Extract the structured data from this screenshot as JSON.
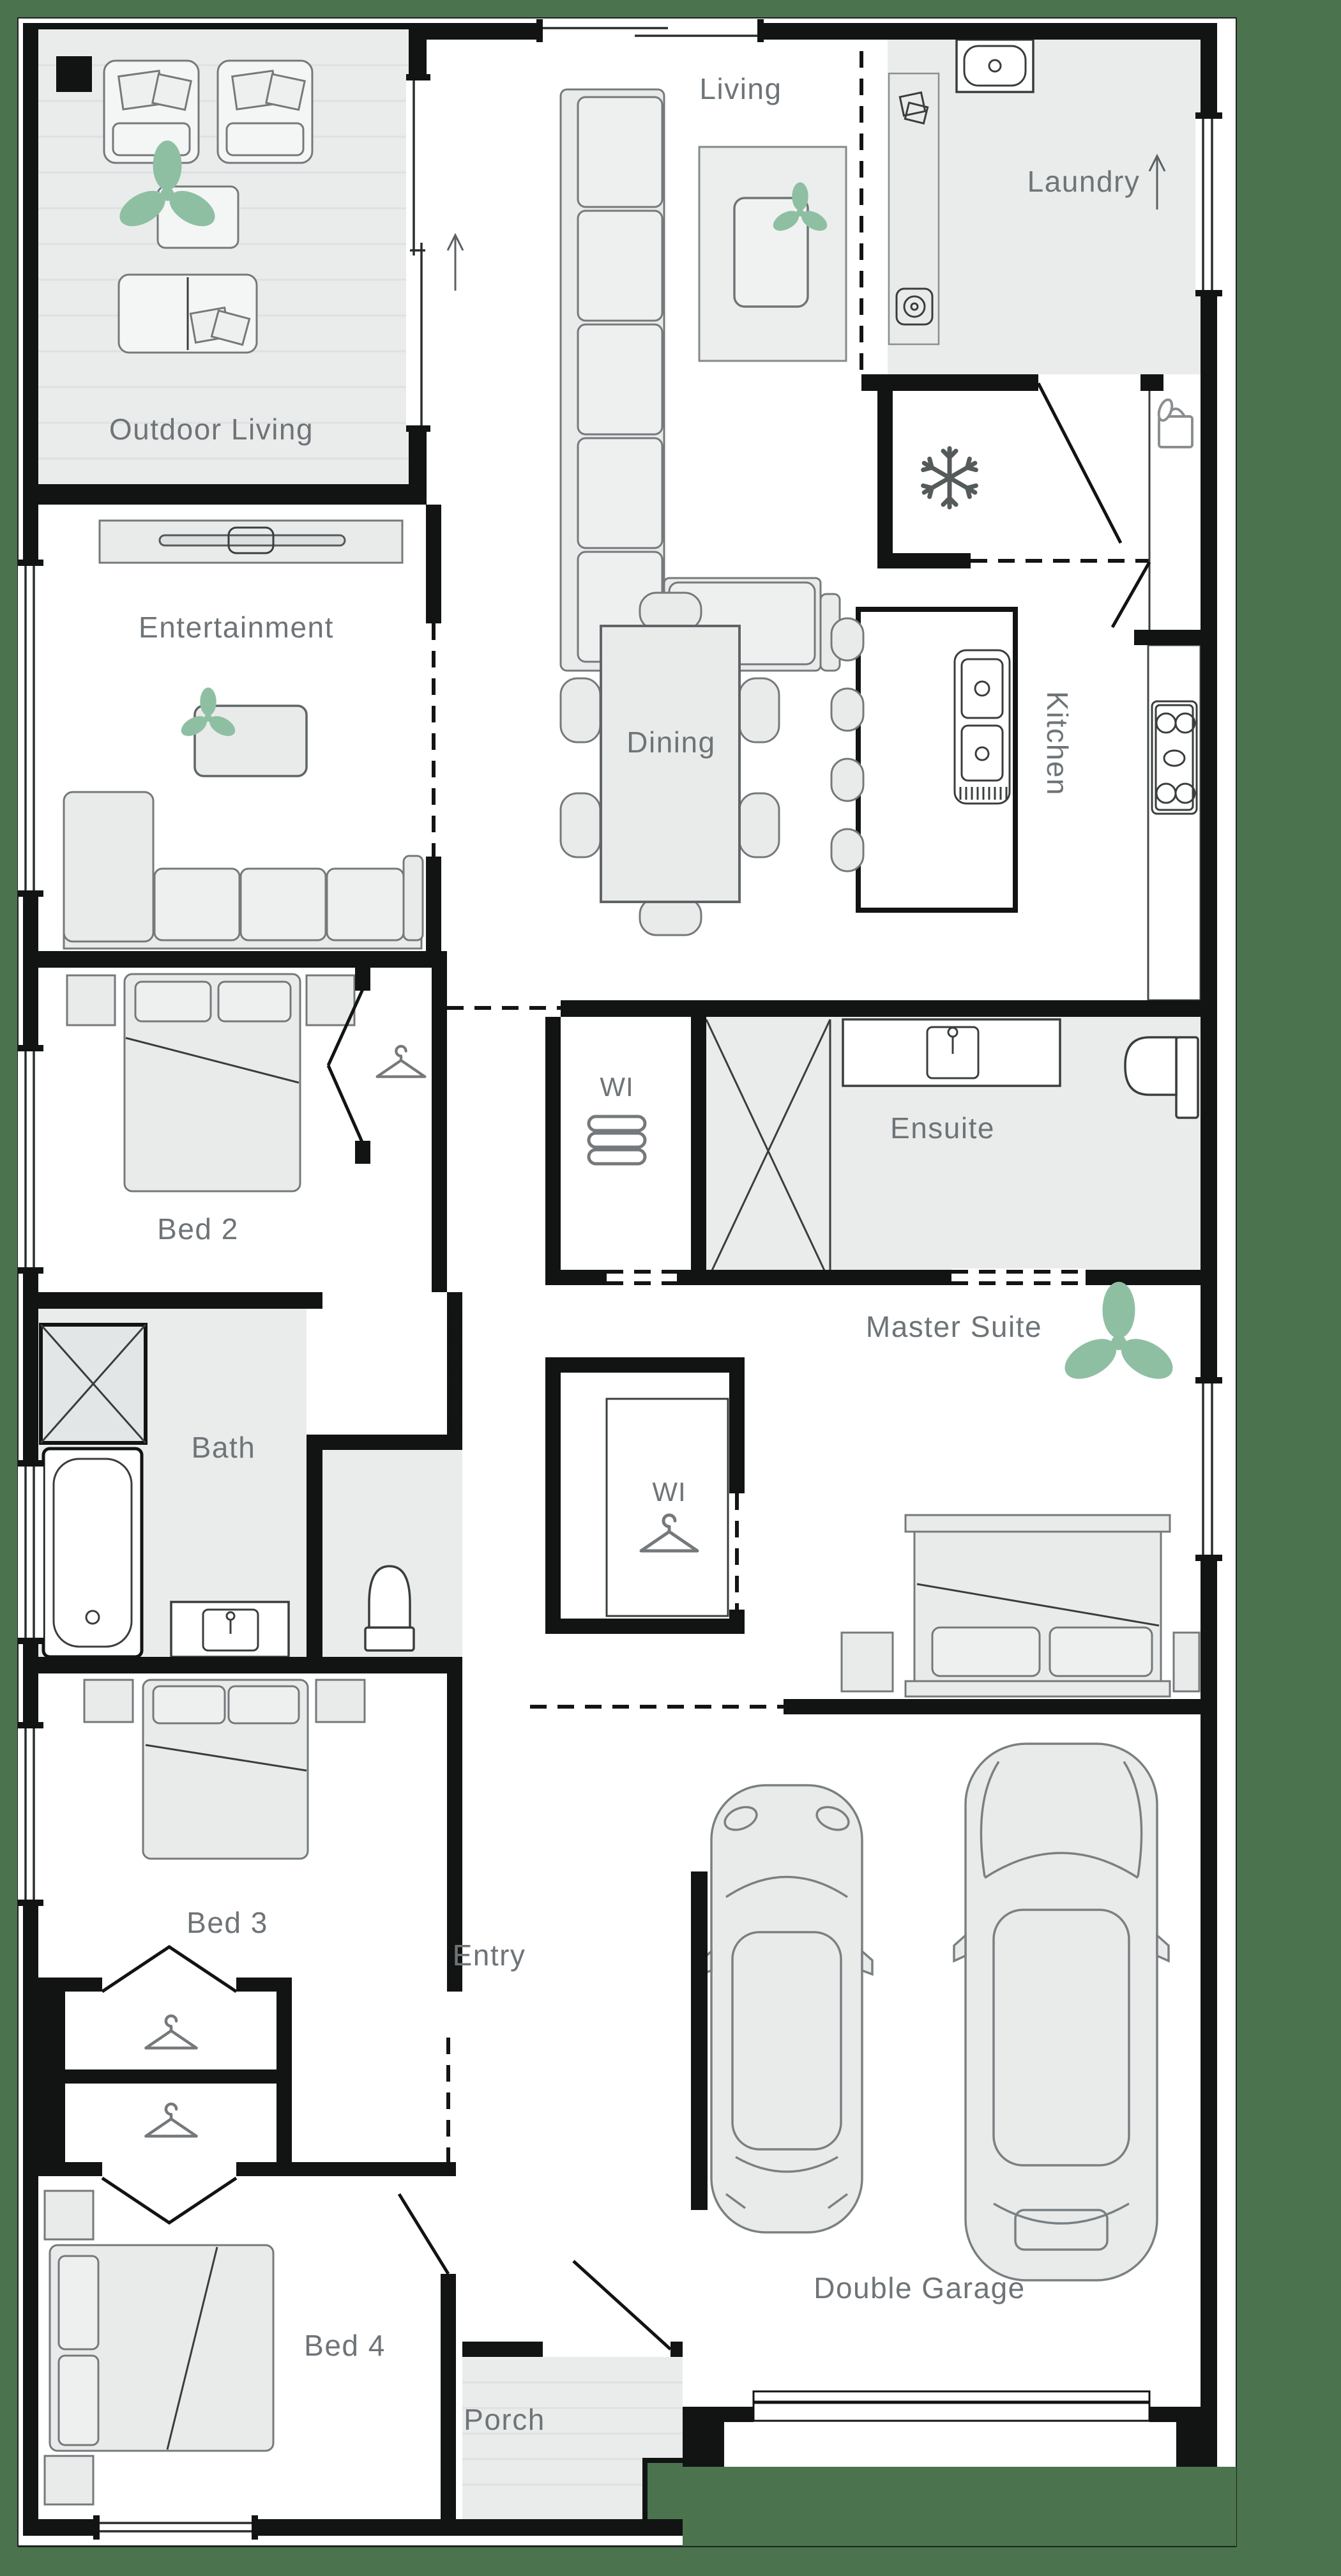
{
  "title": "Single storey home floor plan",
  "rooms": {
    "outdoor_living": {
      "label": "Outdoor Living"
    },
    "living": {
      "label": "Living"
    },
    "laundry": {
      "label": "Laundry"
    },
    "entertainment": {
      "label": "Entertainment"
    },
    "dining": {
      "label": "Dining"
    },
    "kitchen": {
      "label": "Kitchen"
    },
    "bed2": {
      "label": "Bed 2"
    },
    "wi_hall": {
      "label": "WI"
    },
    "ensuite": {
      "label": "Ensuite"
    },
    "master_suite": {
      "label": "Master Suite"
    },
    "wi_master": {
      "label": "WI"
    },
    "bath": {
      "label": "Bath"
    },
    "bed3": {
      "label": "Bed 3"
    },
    "entry": {
      "label": "Entry"
    },
    "bed4": {
      "label": "Bed 4"
    },
    "porch": {
      "label": "Porch"
    },
    "garage": {
      "label": "Double Garage"
    }
  },
  "icons": {
    "plant-icon": "monstera plant",
    "snowflake-icon": "fridge/freezer",
    "hanger-icon": "wardrobe hanger",
    "towel-icon": "folded linen",
    "bread-icon": "pantry bag",
    "cooktop-icon": "gas cooktop",
    "sink-icon": "sink",
    "toilet-icon": "toilet",
    "bathtub-icon": "bathtub",
    "shower-icon": "shower",
    "washer-icon": "laundry appliances",
    "tv-icon": "television unit",
    "car-icon": "car (top view)",
    "arrow-icon": "direction arrow"
  },
  "colors": {
    "background": "#4a734e",
    "wall": "#121414",
    "floor": "#ffffff",
    "wet_area_tint": "#eaecec",
    "furniture_fill": "#e9ebeb",
    "furniture_stroke": "#75797b",
    "label_text": "#6e7477",
    "plant_green": "#8fbfa2"
  }
}
